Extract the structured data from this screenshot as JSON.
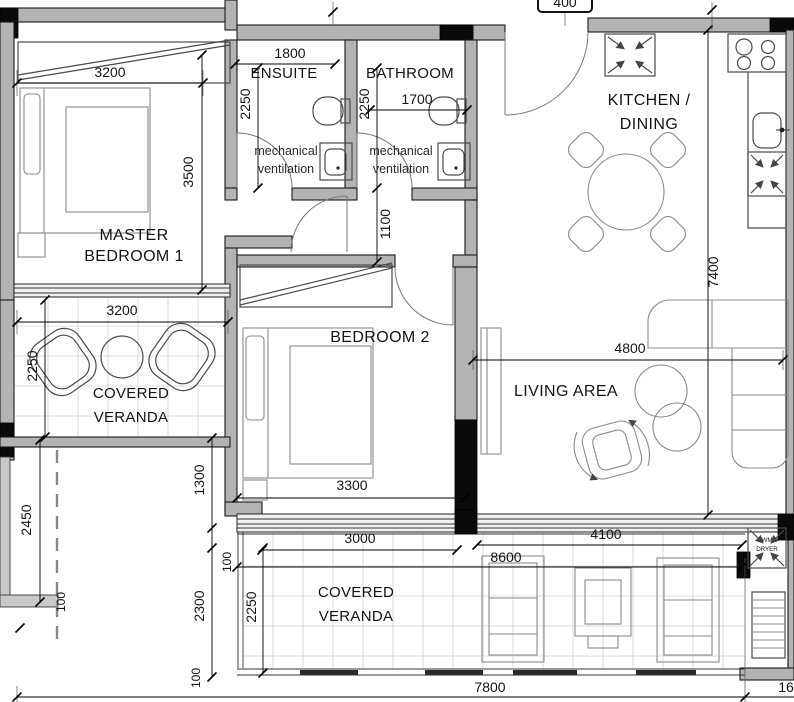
{
  "rooms": {
    "master_bedroom": {
      "line1": "MASTER",
      "line2": "BEDROOM 1"
    },
    "ensuite": {
      "label": "ENSUITE"
    },
    "bathroom": {
      "label": "BATHROOM"
    },
    "kitchen_dining": {
      "line1": "KITCHEN /",
      "line2": "DINING"
    },
    "bedroom2": {
      "label": "BEDROOM 2"
    },
    "living_area": {
      "label": "LIVING AREA"
    },
    "veranda_left": {
      "line1": "COVERED",
      "line2": "VERANDA"
    },
    "veranda_bottom": {
      "line1": "COVERED",
      "line2": "VERANDA"
    },
    "utility": {
      "line1": "WM",
      "line2": "DRYER"
    }
  },
  "notes": {
    "mech_vent_ensuite": {
      "line1": "mechanical",
      "line2": "ventilation"
    },
    "mech_vent_bathroom": {
      "line1": "mechanical",
      "line2": "ventilation"
    }
  },
  "dims": {
    "master_width": "3200",
    "master_depth": "3500",
    "ensuite_width": "1800",
    "ensuite_depth": "2250",
    "bathroom_width": "1700",
    "bathroom_depth": "2250",
    "hallway_width": "1100",
    "kitchen_living_depth": "7400",
    "living_width": "4800",
    "veranda_left_width": "3200",
    "veranda_left_depth": "2250",
    "bedroom2_width": "3300",
    "bedroom2_depth": "3200",
    "offset_1300": "1300",
    "boundary_2450": "2450",
    "wall_100_left": "100",
    "wall_100_mid": "100",
    "wall_100_bottom": "100",
    "offset_2300": "2300",
    "veranda_bottom_depth": "2250",
    "veranda_bottom_3000": "3000",
    "veranda_bottom_total": "8600",
    "veranda_bottom_4100": "4100",
    "overall_width": "7800",
    "overall_right_partial": "16",
    "top_clipped": "400"
  },
  "colors": {
    "wall": "#b3b3b3",
    "column": "#0a0a0a",
    "tile_line": "#d2d2d2",
    "ink": "#141414"
  }
}
